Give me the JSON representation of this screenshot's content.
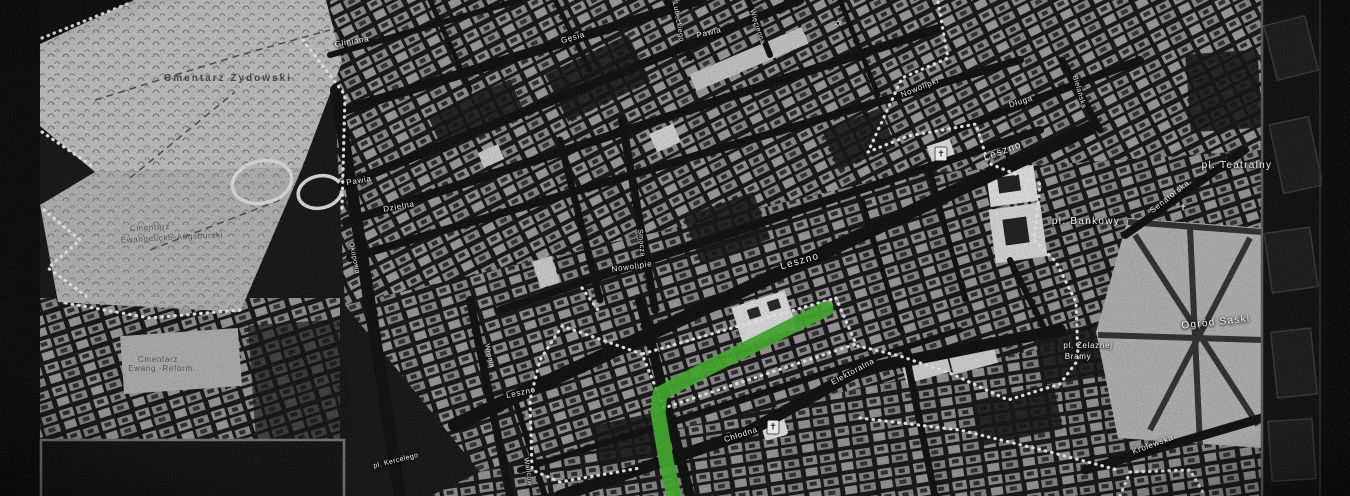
{
  "map": {
    "description": "Black-and-white historical street map of Warsaw (ghetto-era) with dotted boundary line and a highlighted green route",
    "route": {
      "color": "#41b02a",
      "width": "15",
      "points": "826,309 700,372 660,394 658,412 666,460 674,496"
    },
    "boundary": {
      "color": "#efefef"
    },
    "labels": [
      {
        "text": "Cmentarz Żydowski"
      },
      {
        "text": "Cmentarz"
      },
      {
        "text": "Ewangelicko-Augsburski"
      },
      {
        "text": "Cmentarz"
      },
      {
        "text": "Ewang.-Reform."
      },
      {
        "text": "Gliniana"
      },
      {
        "text": "Gęsia"
      },
      {
        "text": "Lubeckiego"
      },
      {
        "text": "Pawia"
      },
      {
        "text": "Więzienna"
      },
      {
        "text": "Pawia"
      },
      {
        "text": "Dzielna"
      },
      {
        "text": "Okopowa"
      },
      {
        "text": "Smocza"
      },
      {
        "text": "Nowolipie"
      },
      {
        "text": "Leszno"
      },
      {
        "text": "Leszno"
      },
      {
        "text": "Nowolipki"
      },
      {
        "text": "Długa"
      },
      {
        "text": "Bielańska"
      },
      {
        "text": "pl. Teatralny"
      },
      {
        "text": "Senatorska"
      },
      {
        "text": "pl. Bankowy"
      },
      {
        "text": "Ogród Saski"
      },
      {
        "text": "pl. Żelaznej"
      },
      {
        "text": "Bramy"
      },
      {
        "text": "Królewska"
      },
      {
        "text": "Elektoralna"
      },
      {
        "text": "Chłodna"
      },
      {
        "text": "pl. Kercelego"
      },
      {
        "text": "Wronia"
      },
      {
        "text": "Leszno"
      },
      {
        "text": "Waliców"
      }
    ],
    "icons": [
      {
        "name": "synagogue-star-icon",
        "glyph": "✡"
      },
      {
        "name": "church-cross-icon",
        "glyph": "✝"
      },
      {
        "name": "church-cross-icon",
        "glyph": "✝"
      },
      {
        "name": "church-cross-icon",
        "glyph": "✝"
      }
    ]
  }
}
